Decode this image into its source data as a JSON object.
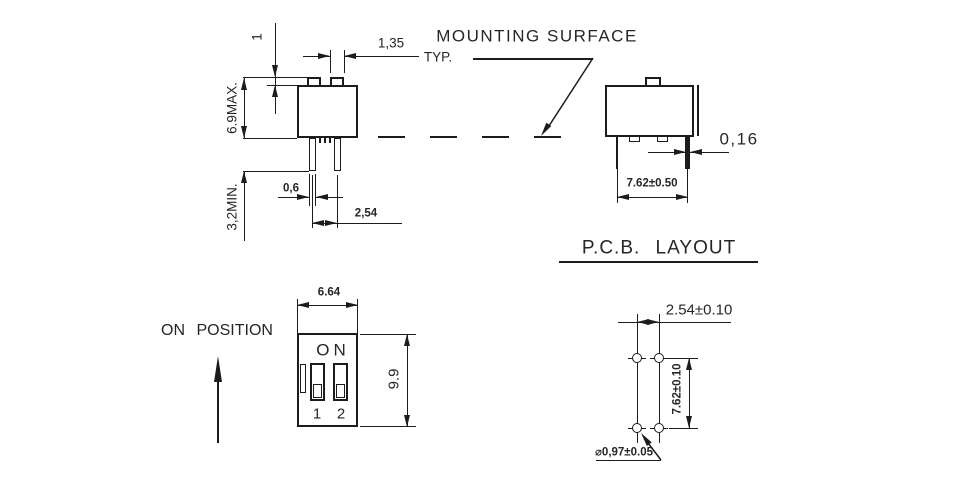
{
  "drawing": {
    "type": "dip-switch-technical-drawing",
    "labels": {
      "mounting_surface": "MOUNTING SURFACE",
      "pcb_layout_title": "P.C.B. LAYOUT",
      "on_position": "ON POSITION"
    },
    "side_view": {
      "actuator_height": "1",
      "actuator_width": "1,35",
      "typ": "TYP.",
      "overall_height": "6.9MAX.",
      "pin_length": "3,2MIN.",
      "pin_width": "0,6",
      "pin_pitch": "2,54"
    },
    "end_view": {
      "pin_thickness": "0,16",
      "row_pitch": "7.62±0.50"
    },
    "front_view": {
      "on": "ON",
      "switch_1": "1",
      "switch_2": "2",
      "width": "6.64",
      "height": "9.9"
    },
    "pcb_layout": {
      "hole_pitch": "2.54±0.10",
      "row_pitch": "7.62±0.10",
      "hole_diameter": "⌀0,97±0.05"
    },
    "colors": {
      "line": "#1c1c1c",
      "text": "#262626",
      "background": "#ffffff"
    }
  }
}
